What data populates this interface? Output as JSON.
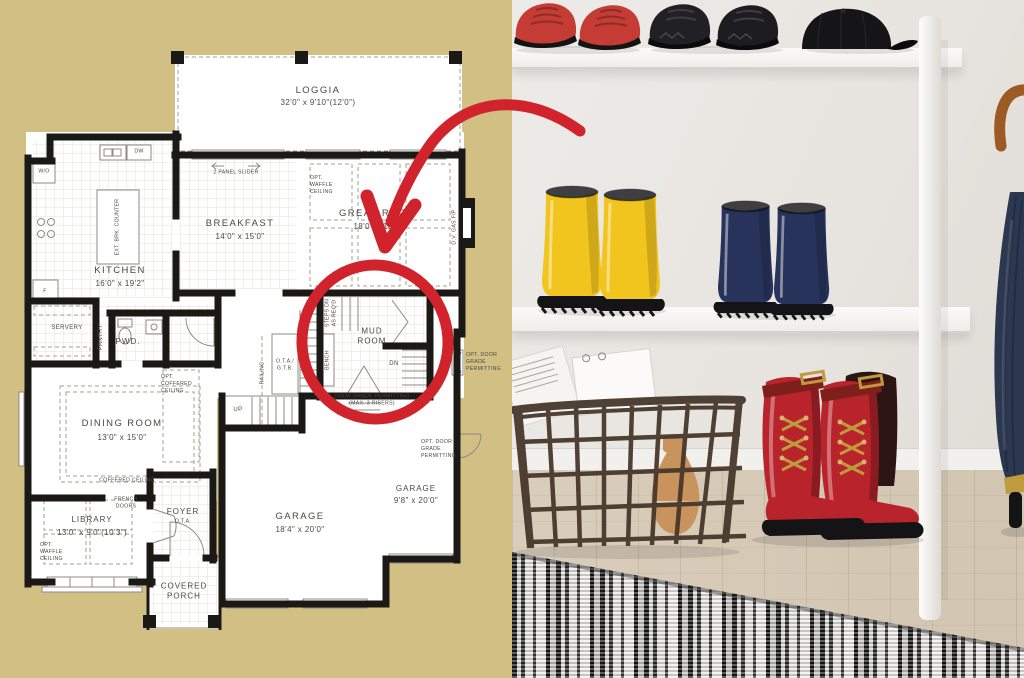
{
  "plan": {
    "rooms": {
      "loggia": {
        "name": "LOGGIA",
        "dims": "32'0\" x 9'10\"(12'0\")"
      },
      "breakfast": {
        "name": "BREAKFAST",
        "dims": "14'0\" x 15'0\""
      },
      "great_room": {
        "name": "GREAT ROOM",
        "dims": "18'0\" x 15'0\""
      },
      "kitchen": {
        "name": "KITCHEN",
        "dims": "16'0\" x 19'2\""
      },
      "dining_room": {
        "name": "DINING ROOM",
        "dims": "13'0\" x 15'0\""
      },
      "library": {
        "name": "LIBRARY",
        "dims": "13'0\" x 9'0\"(10'3\")"
      },
      "garage": {
        "name": "GARAGE",
        "dims": "18'4\" x 20'0\""
      },
      "garage_tandem": {
        "name": "GARAGE",
        "dims": "9'8\" x 20'0\""
      },
      "mud_room": {
        "name": "MUD ROOM"
      },
      "foyer": {
        "name": "FOYER",
        "sub": "O.T.A."
      },
      "covered_porch": {
        "name": "COVERED PORCH"
      },
      "powder_room": {
        "name": "PWD."
      },
      "servery": {
        "name": "SERVERY"
      },
      "pantry": {
        "name": "PANTRY"
      }
    },
    "annotations": {
      "two_panel_slider": "2 PANEL SLIDER",
      "opt_waffle_ceiling_great": "OPT. WAFFLE CEILING",
      "opt_waffle_ceiling_library": "OPT. WAFFLE CEILING",
      "opt_coffered_ceiling": "OPT. COFFERED CEILING",
      "coffered_ceiling": "COFFERED CEILING",
      "french_doors": "FRENCH DOORS",
      "ext_brk_counter": "EXT. BRK. COUNTER",
      "dv_gas_fp": "D.V. GAS F/P",
      "steps_dn": "STEPS DN AS REQ'D",
      "bench": "BENCH",
      "railing": "RAILING",
      "ota_gtb": "O.T.A./ G.T.B.",
      "up": "UP",
      "dn": "DN",
      "walkout": "W/O",
      "dishwasher": "DW",
      "fridge": "F",
      "door_grade": "DOOR GRADE PERMITTING (MAX. 3 RISERS)",
      "opt_door_grade_mud": "OPT. DOOR GRADE PERMITTING",
      "opt_door_grade_garage": "OPT. DOOR GRADE PERMITTING"
    }
  },
  "photo": {
    "items": [
      "red-sneakers",
      "black-sneakers",
      "black-baseball-cap",
      "yellow-rain-boots",
      "navy-rain-boots",
      "wire-storage-basket",
      "magazines-and-notebook",
      "wooden-vase",
      "red-lace-up-boots",
      "dark-boot",
      "navy-umbrella",
      "wooden-umbrella-handle",
      "white-shelf-unit",
      "striped-rug",
      "wood-floor"
    ]
  },
  "colors": {
    "tan": "#d1bf84",
    "red": "#d1232b",
    "ink": "#4a4944",
    "wall": "#1a1916",
    "yellow": "#f2c41e",
    "navy": "#27335a",
    "sneaker_red": "#c43c34",
    "boot_red": "#b9242c",
    "black": "#17171a",
    "basket": "#46362a",
    "vase": "#c8935d",
    "gold": "#c09a3e",
    "umbrella": "#2c3850",
    "wood_handle": "#9c5a24",
    "shelf": "#f6f5f3",
    "photo_wall": "#e8e5e1",
    "floor_wood": "#d6c9b6"
  }
}
